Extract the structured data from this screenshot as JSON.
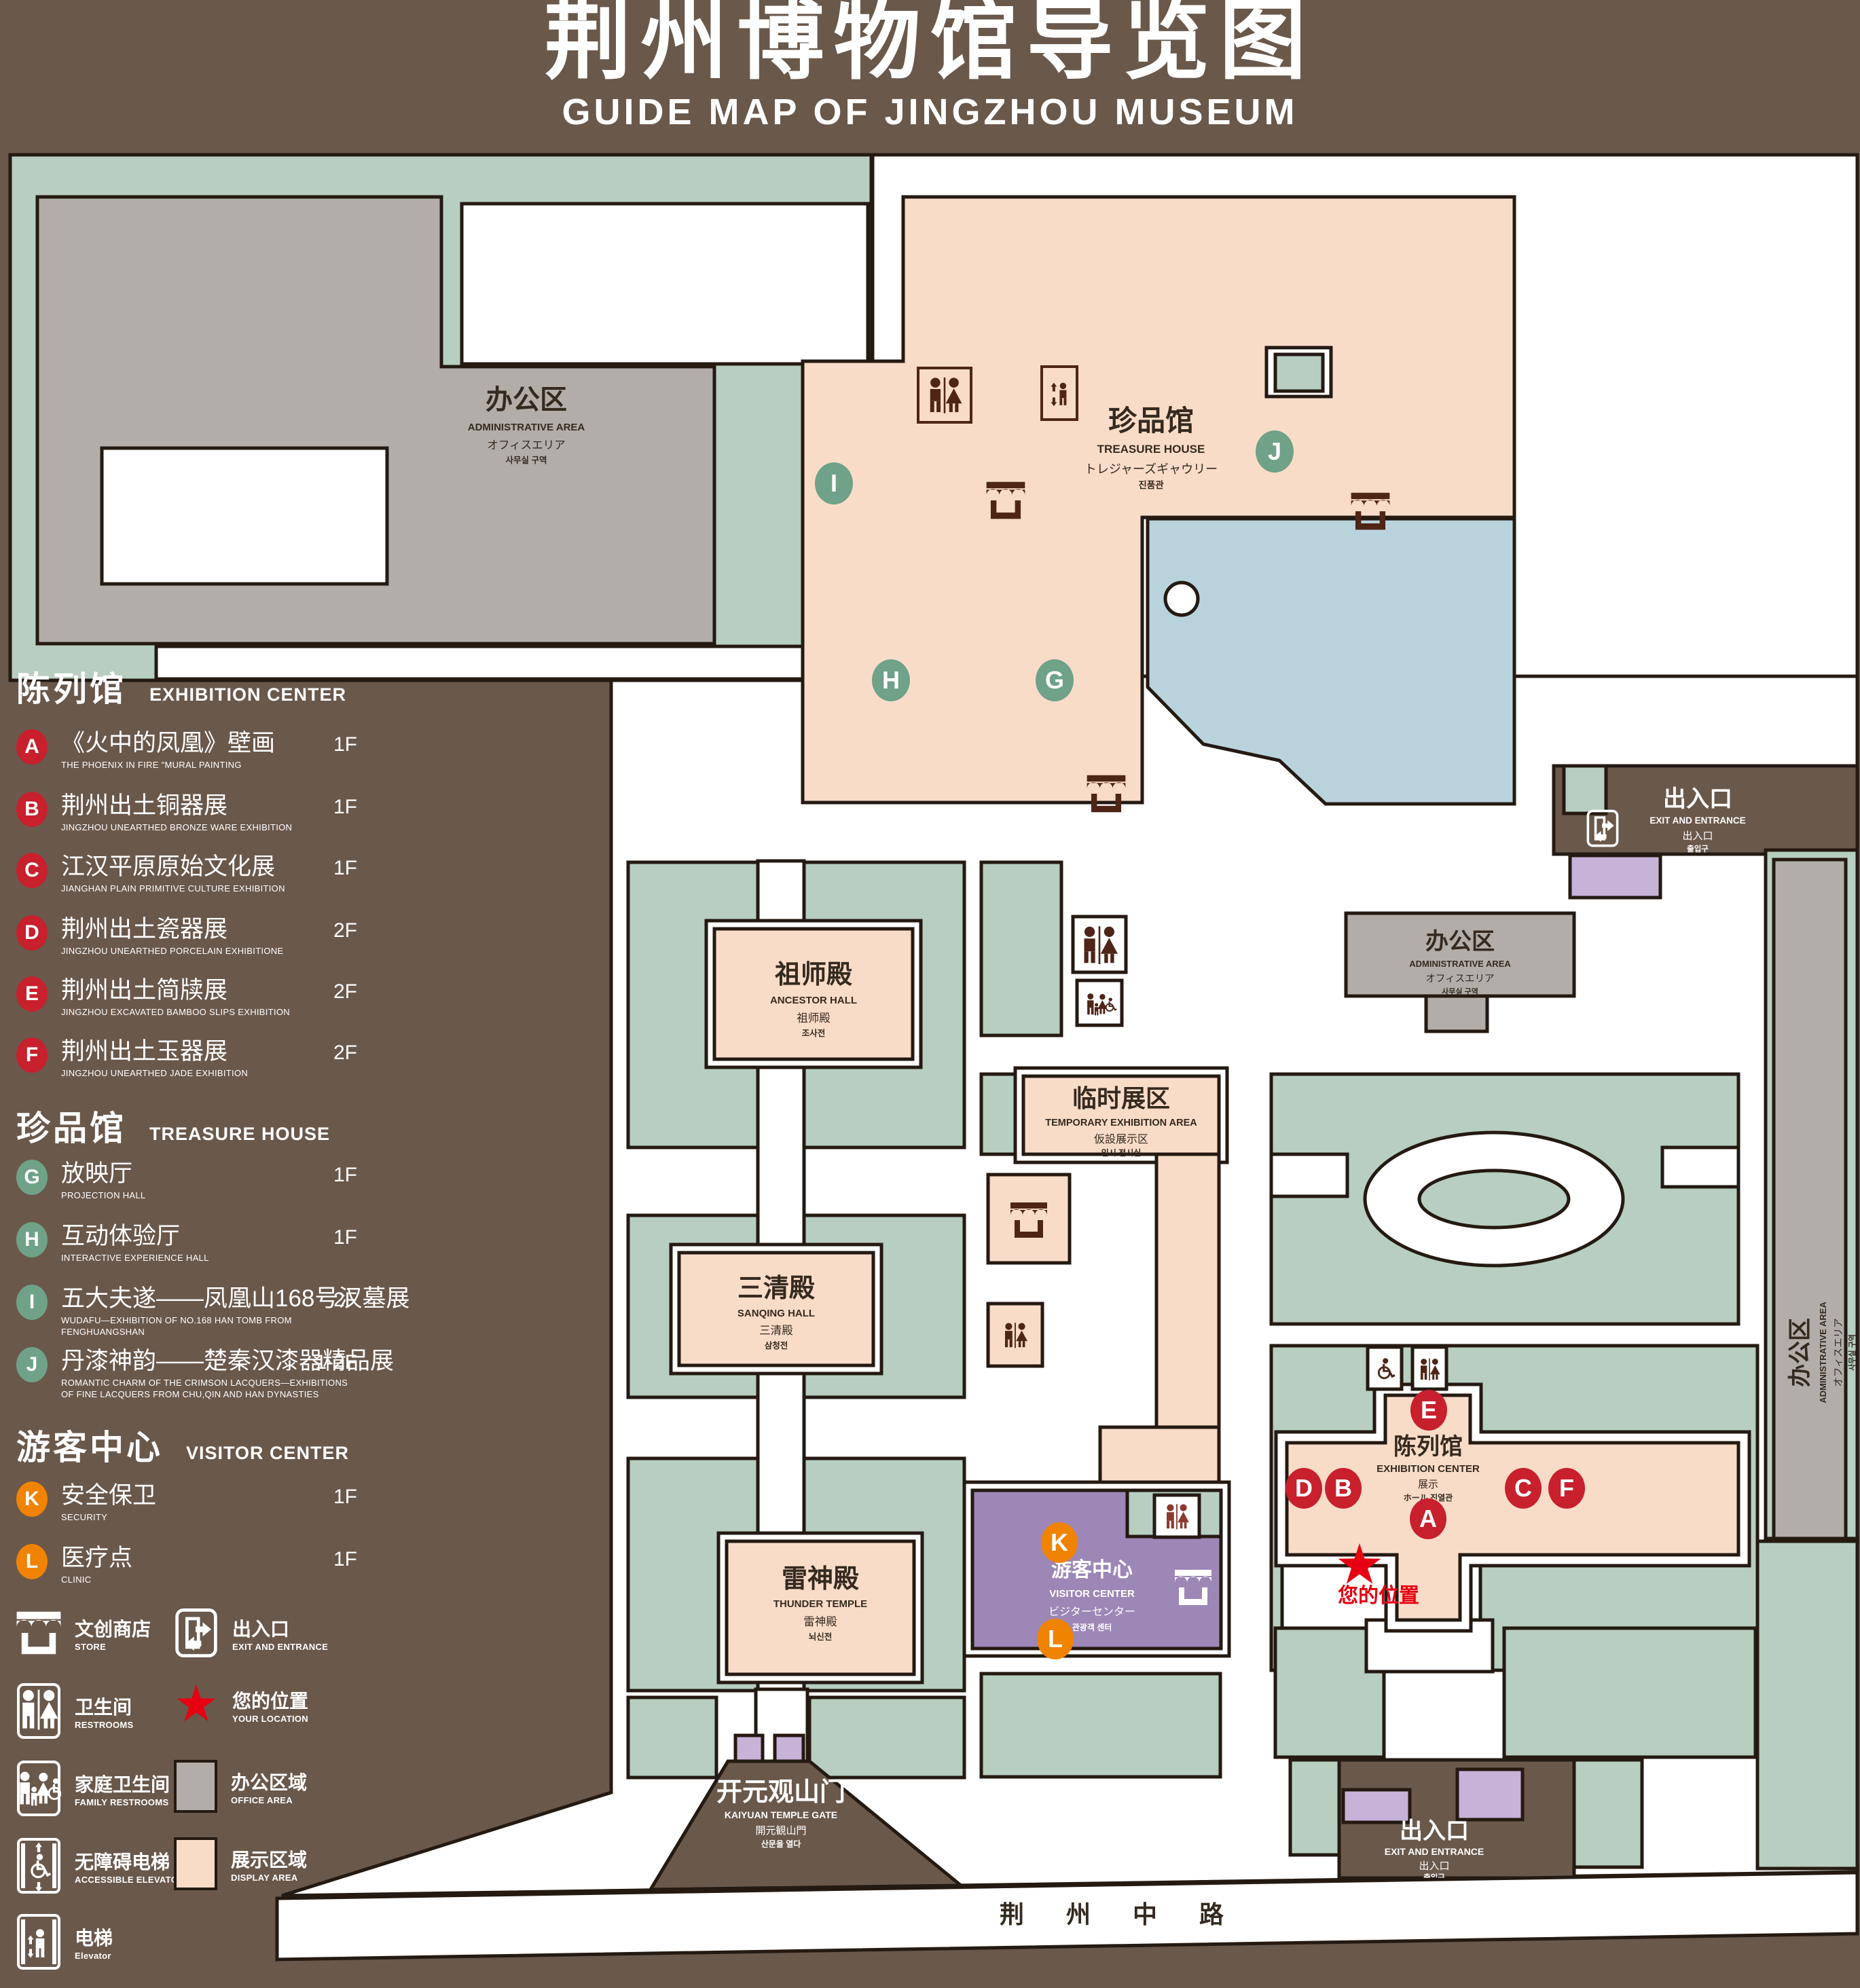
{
  "title": {
    "zh": "荆州博物馆导览图",
    "en": "GUIDE MAP OF JINGZHOU MUSEUM"
  },
  "legend": {
    "sections": [
      {
        "zh": "陈列馆",
        "en": "EXHIBITION CENTER"
      },
      {
        "zh": "珍品馆",
        "en": "TREASURE HOUSE"
      },
      {
        "zh": "游客中心",
        "en": "VISITOR CENTER"
      }
    ],
    "items": [
      {
        "letter": "A",
        "zh": "《火中的凤凰》壁画",
        "en": "THE PHOENIX IN FIRE \"MURAL PAINTING",
        "floor": "1F"
      },
      {
        "letter": "B",
        "zh": "荆州出土铜器展",
        "en": "JINGZHOU UNEARTHED BRONZE WARE EXHIBITION",
        "floor": "1F"
      },
      {
        "letter": "C",
        "zh": "江汉平原原始文化展",
        "en": "JIANGHAN PLAIN PRIMITIVE CULTURE EXHIBITION",
        "floor": "1F"
      },
      {
        "letter": "D",
        "zh": "荆州出土瓷器展",
        "en": "JINGZHOU UNEARTHED PORCELAIN EXHIBITIONE",
        "floor": "2F"
      },
      {
        "letter": "E",
        "zh": "荆州出土简牍展",
        "en": "JINGZHOU EXCAVATED BAMBOO SLIPS EXHIBITION",
        "floor": "2F"
      },
      {
        "letter": "F",
        "zh": "荆州出土玉器展",
        "en": "JINGZHOU UNEARTHED JADE EXHIBITION",
        "floor": "2F"
      },
      {
        "letter": "G",
        "zh": "放映厅",
        "en": "PROJECTION HALL",
        "floor": "1F"
      },
      {
        "letter": "H",
        "zh": "互动体验厅",
        "en": "INTERACTIVE EXPERIENCE HALL",
        "floor": "1F"
      },
      {
        "letter": "I",
        "zh": "五大夫遂——凤凰山168号汉墓展",
        "en": "WUDAFU—EXHIBITION OF NO.168 HAN TOMB FROM FENGHUANGSHAN",
        "floor": "2F"
      },
      {
        "letter": "J",
        "zh": "丹漆神韵——楚秦汉漆器精品展",
        "en": "ROMANTIC CHARM OF THE CRIMSON LACQUERS—EXHIBITIONS OF FINE LACQUERS FROM CHU,QIN AND HAN DYNASTIES",
        "floor": "1-2F"
      },
      {
        "letter": "K",
        "zh": "安全保卫",
        "en": "SECURITY",
        "floor": "1F"
      },
      {
        "letter": "L",
        "zh": "医疗点",
        "en": "CLINIC",
        "floor": "1F"
      }
    ],
    "icons": {
      "store": {
        "zh": "文创商店",
        "en": "STORE"
      },
      "exit": {
        "zh": "出入口",
        "en": "EXIT AND ENTRANCE"
      },
      "restroom": {
        "zh": "卫生间",
        "en": "RESTROOMS"
      },
      "location": {
        "zh": "您的位置",
        "en": "YOUR LOCATION"
      },
      "family": {
        "zh": "家庭卫生间",
        "en": "FAMILY RESTROOMS"
      },
      "office": {
        "zh": "办公区域",
        "en": "OFFICE AREA"
      },
      "accessible": {
        "zh": "无障碍电梯",
        "en": "ACCESSIBLE ELEVATOR"
      },
      "display": {
        "zh": "展示区域",
        "en": "DISPLAY AREA"
      },
      "elevator": {
        "zh": "电梯",
        "en": "Elevator"
      }
    }
  },
  "map": {
    "admin_topleft": {
      "zh": "办公区",
      "en": "ADMINISTRATIVE AREA",
      "l3": "オフィスエリア",
      "l4": "사무실 구역"
    },
    "treasure": {
      "zh": "珍品馆",
      "en": "TREASURE HOUSE",
      "l3": "トレジャーズギャウリー",
      "l4": "진품관"
    },
    "exit_topright": {
      "zh": "出入口",
      "en": "EXIT AND ENTRANCE",
      "l3": "出入口",
      "l4": "출입구"
    },
    "admin_right": {
      "zh": "办公区",
      "en": "ADMINISTRATIVE AREA",
      "l3": "オフィスエリア",
      "l4": "사무실 구역"
    },
    "admin_far_right": {
      "zh": "办公区",
      "en": "ADMINISTRATIVE AREA",
      "l3": "オフィスエリア",
      "l4": "사무실 구역"
    },
    "ancestor": {
      "zh": "祖师殿",
      "en": "ANCESTOR HALL",
      "l3": "祖师殿",
      "l4": "조사전"
    },
    "temp": {
      "zh": "临时展区",
      "en": "TEMPORARY EXHIBITION AREA",
      "l3": "仮設展示区",
      "l4": "임시 전시실"
    },
    "sanqing": {
      "zh": "三清殿",
      "en": "SANQING HALL",
      "l3": "三清殿",
      "l4": "삼청전"
    },
    "thunder": {
      "zh": "雷神殿",
      "en": "THUNDER TEMPLE",
      "l3": "雷神殿",
      "l4": "뇌신전"
    },
    "visitor": {
      "zh": "游客中心",
      "en": "VISITOR CENTER",
      "l3": "ビジターセンター",
      "l4": "관광객 센터"
    },
    "exhibition": {
      "zh": "陈列馆",
      "en": "EXHIBITION CENTER",
      "l3": "展示",
      "l4": "ホール 진열관"
    },
    "gate": {
      "zh": "开元观山门",
      "en": "KAIYUAN TEMPLE GATE",
      "l3": "開元観山門",
      "l4": "산문을 열다"
    },
    "exit_bottom": {
      "zh": "出入口",
      "en": "EXIT AND ENTRANCE",
      "l3": "出入口",
      "l4": "출입구"
    },
    "road": "荆 州 中 路",
    "your_location": "您的位置",
    "markers": {
      "a": "A",
      "b": "B",
      "c": "C",
      "d": "D",
      "e": "E",
      "f": "F",
      "g": "G",
      "h": "H",
      "i": "I",
      "j": "J",
      "k": "K",
      "l": "L"
    }
  },
  "colors": {
    "background": "#6A584B",
    "green_area": "#B7CEC1",
    "display_area": "#F9DCC8",
    "office_area": "#B2ADA9",
    "visitor_center": "#9C87B7",
    "exit_building": "#C7B2D8",
    "water": "#B9D3DD",
    "marker_red": "#C8202D",
    "marker_green": "#6FA288",
    "marker_orange": "#F08300",
    "location_red": "#E60012",
    "outline": "#241A12"
  }
}
